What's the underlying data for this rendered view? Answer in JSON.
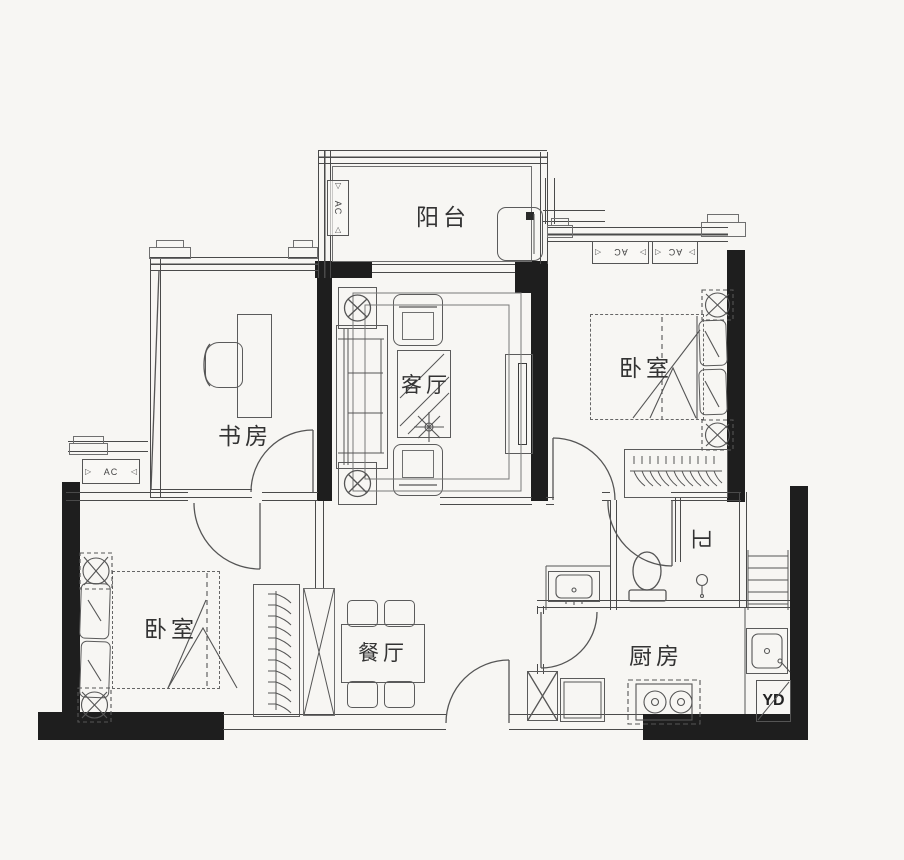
{
  "canvas": {
    "width": 904,
    "height": 860
  },
  "rooms": {
    "balcony": {
      "label": "阳台"
    },
    "study": {
      "label": "书房"
    },
    "living_room": {
      "label": "客厅"
    },
    "bedroom_right": {
      "label": "卧室"
    },
    "bedroom_left": {
      "label": "卧室"
    },
    "dining_room": {
      "label": "餐厅"
    },
    "kitchen": {
      "label": "厨房"
    },
    "bathroom": {
      "label": "卫"
    }
  },
  "annotations": {
    "ac": "AC",
    "yd": "YD"
  },
  "fixtures": [
    "bed",
    "wardrobe-hangers",
    "sofa",
    "tv-cabinet",
    "coffee-table",
    "plant",
    "armchair",
    "dining-table",
    "dining-chairs",
    "desk",
    "desk-chair",
    "toilet",
    "vanity-sink",
    "kitchen-sink",
    "stove",
    "fridge",
    "washing-machine",
    "shower-head",
    "nightstand",
    "duct-shaft"
  ],
  "colors": {
    "background": "#f7f6f3",
    "wall": "#1e1e1e",
    "line": "#555555",
    "text": "#333333"
  }
}
